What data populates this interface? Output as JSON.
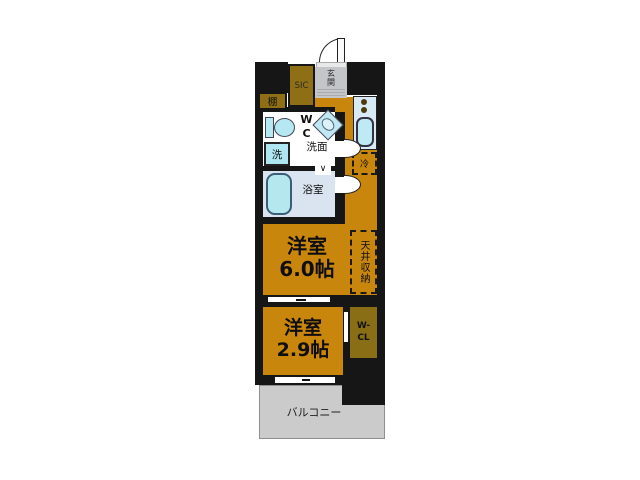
{
  "colors": {
    "wall": "#161616",
    "floor": "#c8860d",
    "closet": "#8e6f15",
    "wcl": "#8a6e15",
    "bathfloor": "#d9e4f0",
    "fixture": "#b5e8f2",
    "counter": "#d8eaf5",
    "entrance": "#c4c5c8",
    "balcony": "#cbcbcb"
  },
  "plan": {
    "entrance": {
      "label": "玄関"
    },
    "sic": {
      "label": "SIC"
    },
    "shelf": {
      "label": "棚"
    },
    "wc": {
      "line1": "W",
      "line2": "C"
    },
    "basin": {
      "label": "洗面"
    },
    "washer": {
      "label": "洗"
    },
    "bath": {
      "label": "浴室",
      "door_mark": "∨"
    },
    "fridge": {
      "label": "冷"
    },
    "ceiling_storage": {
      "label": "天井収納"
    },
    "room_main": {
      "name": "洋室",
      "size": "6.0帖"
    },
    "room_sub": {
      "name": "洋室",
      "size": "2.9帖"
    },
    "wcl": {
      "line1": "W-",
      "line2": "CL"
    },
    "balcony": {
      "label": "バルコニー"
    }
  }
}
